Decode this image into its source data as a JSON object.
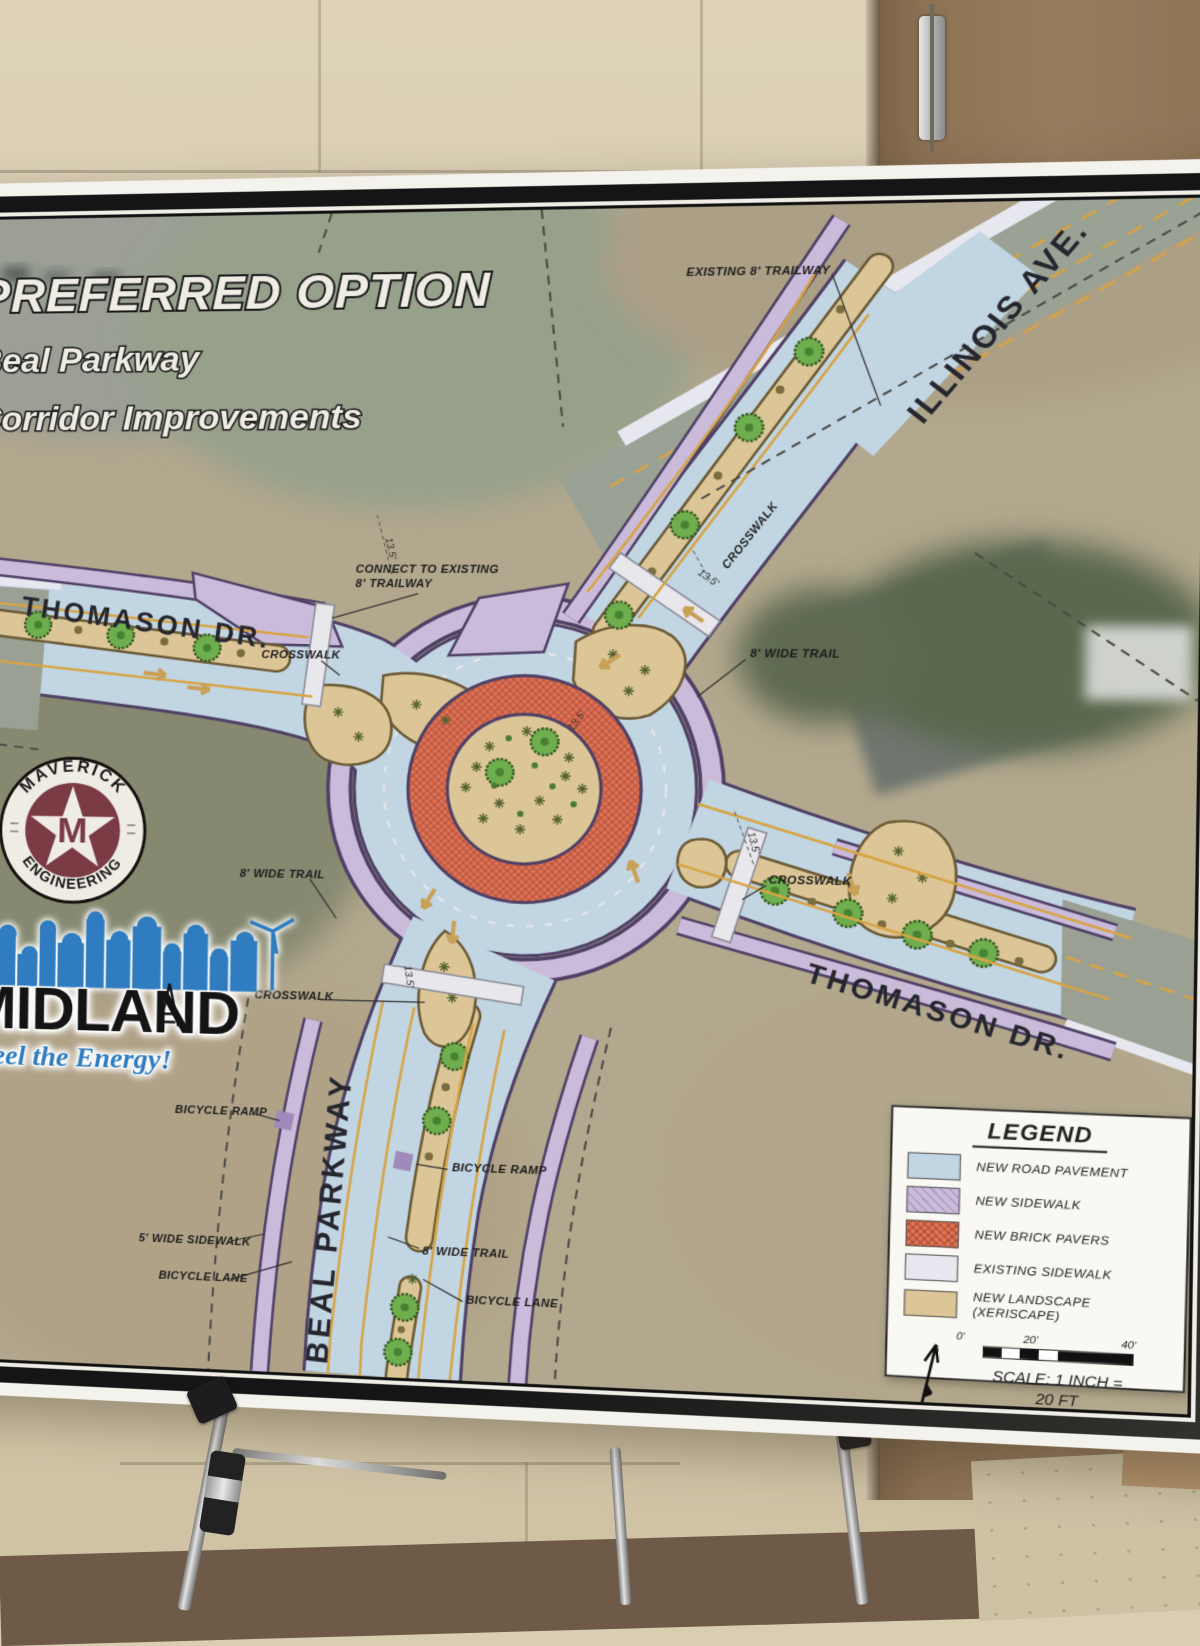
{
  "poster": {
    "title_line1": "PREFERRED OPTION",
    "title_line2": "Beal Parkway",
    "title_line3": "Corridor Improvements"
  },
  "streets": {
    "illinois": "ILLINOIS AVE.",
    "thomason_left": "THOMASON DR.",
    "thomason_right": "THOMASON DR.",
    "beal": "BEAL PARKWAY"
  },
  "callouts": {
    "existing_trailway": "EXISTING 8' TRAILWAY",
    "connect_line1": "CONNECT TO EXISTING",
    "connect_line2": "8' TRAILWAY",
    "crosswalk": "CROSSWALK",
    "wide_trail": "8' WIDE TRAIL",
    "wide_sidewalk": "5' WIDE SIDEWALK",
    "bicycle_ramp": "BICYCLE RAMP",
    "bicycle_lane": "BICYCLE LANE",
    "dim": "13.5'"
  },
  "logos": {
    "maverick_top": "MAVERICK",
    "maverick_bottom": "ENGINEERING",
    "maverick_monogram": "M",
    "midland_name": "MIDLAND",
    "midland_tagline": "Feel the Energy!"
  },
  "legend": {
    "title": "LEGEND",
    "items": [
      {
        "label": "NEW ROAD PAVEMENT",
        "color": "#c2d5e2"
      },
      {
        "label": "NEW SIDEWALK",
        "color": "#cabbdb"
      },
      {
        "label": "NEW BRICK PAVERS",
        "color": "#dd7457"
      },
      {
        "label": "EXISTING SIDEWALK",
        "color": "#e7e7ef"
      },
      {
        "label": "NEW LANDSCAPE (XERISCAPE)",
        "color": "#dcc697"
      }
    ],
    "scale_ticks": [
      "0'",
      "20'",
      "40'"
    ],
    "scale_line1": "SCALE: 1 INCH =",
    "scale_line2": "20 FT"
  },
  "map_colors": {
    "new_road": "#c2d5e2",
    "new_sidewalk": "#cabbdb",
    "new_brick": "#dd7457",
    "existing_sidewalk": "#e7e7ef",
    "landscape": "#dcc697"
  }
}
